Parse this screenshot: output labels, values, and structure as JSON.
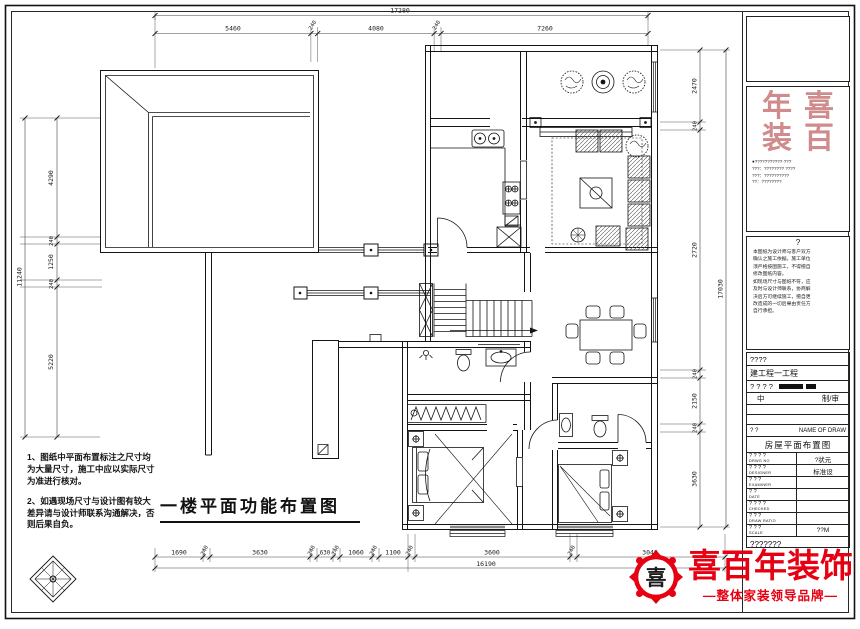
{
  "plan": {
    "title": "一楼平面功能布置图"
  },
  "dims": {
    "top": {
      "overall": "17280",
      "segments": [
        "5460",
        "240",
        "4080",
        "240",
        "7260"
      ]
    },
    "left": {
      "overall": "11240",
      "segments": [
        "4290",
        "240",
        "1250",
        "240",
        "5220"
      ]
    },
    "right": {
      "overall": "17030",
      "segments": [
        "2470",
        "240",
        "2720",
        "240",
        "2150",
        "240",
        "3630"
      ]
    },
    "bottom": {
      "overall": "16190",
      "segments": [
        "1690",
        "240",
        "3630",
        "240",
        "630",
        "240",
        "1060",
        "240",
        "1100",
        "240",
        "3600",
        "240",
        "3040"
      ]
    }
  },
  "notes": {
    "line1": "1、图纸中平面布置标注之尺寸均为大量尺寸，施工中应以实际尺寸为准进行核对。",
    "line2": "2、如遇现场尺寸与设计图有较大差异请与设计师联系沟通解决，否则后果自负。"
  },
  "title_block": {
    "seal": {
      "tl": "年",
      "tr": "喜",
      "bl": "装",
      "br": "百"
    },
    "address_text": "●???????????·???\n???：???????? ????\n???：??????????\n??：????????",
    "desc_header": "?",
    "desc_text": "本图纸为设计师与客户双方\n确认之施工依据，施工单位\n须严格按图施工，不得擅自\n修改图纸内容。\n如现场尺寸与图纸不符，应\n及时与设计师联系，协商解\n决后方可继续施工，擅自更\n改造成的一切后果由责任方\n自行承担。",
    "row_a": "????",
    "row_project": "建工程一工程",
    "row_q": "? ? ? ?",
    "row_mid_left": "中",
    "row_mid_right": "制/审",
    "now_left": "?  ?",
    "now_right": "NAME OF DRAW",
    "drawing_name": "房屋平面布置图",
    "rows": [
      {
        "label": "? ? ? ?",
        "sub": "DRWG NO",
        "value": "?状元"
      },
      {
        "label": "? ? ? ?",
        "sub": "DESIGNER",
        "value": "标准设"
      },
      {
        "label": "? ? ?",
        "sub": "EXAMINER",
        "value": ""
      },
      {
        "label": "? ?",
        "sub": "DATE",
        "value": ""
      },
      {
        "label": "? ? ? ?",
        "sub": "CHECKED",
        "value": ""
      },
      {
        "label": "? ? ?",
        "sub": "DRAW RATIO",
        "value": ""
      },
      {
        "label": "? ? ?",
        "sub": "SCALE",
        "value": "??M"
      }
    ],
    "bottom_q": "???????"
  },
  "logo": {
    "company": "喜百年装饰",
    "tagline": "—整体家装领导品牌—",
    "icon_char": "喜",
    "red": "#e60012",
    "seal_red": "#c87878"
  }
}
